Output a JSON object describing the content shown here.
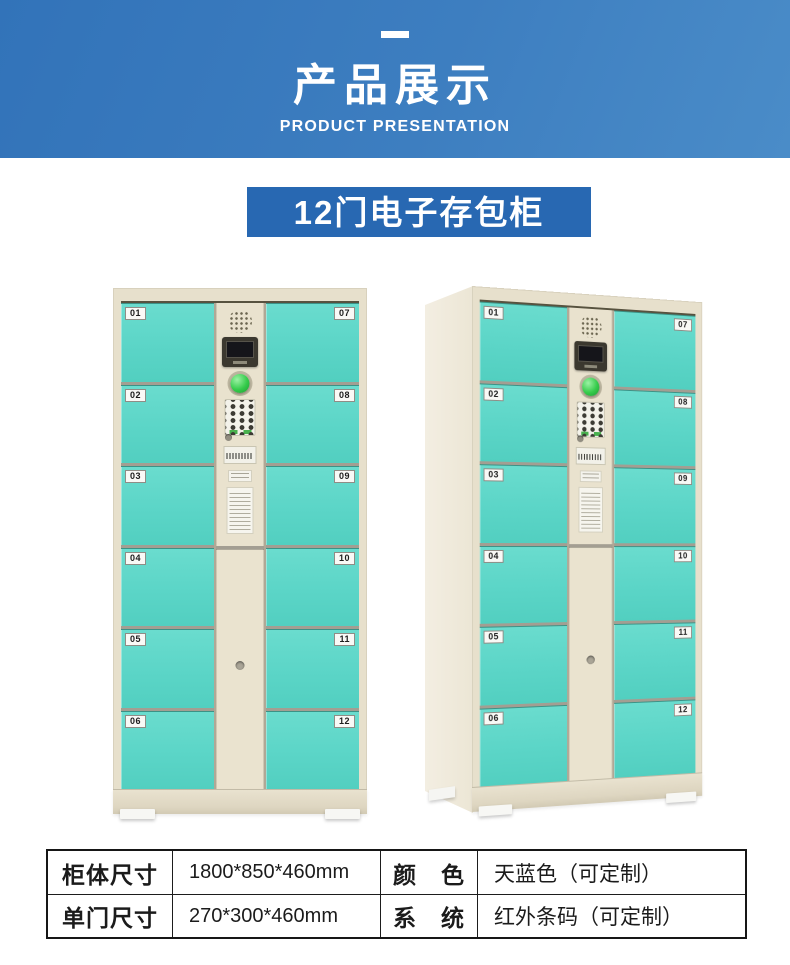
{
  "hero": {
    "title": "产品展示",
    "subtitle": "PRODUCT PRESENTATION"
  },
  "product_banner": {
    "title": "12门电子存包柜"
  },
  "cabinet": {
    "left_doors": [
      "01",
      "02",
      "03",
      "04",
      "05",
      "06"
    ],
    "right_doors": [
      "07",
      "08",
      "09",
      "10",
      "11",
      "12"
    ]
  },
  "spec_table": {
    "rows": [
      {
        "label_a": "柜体尺寸",
        "value_a": "1800*850*460mm",
        "label_b": "颜　色",
        "value_b": "天蓝色（可定制）"
      },
      {
        "label_a": "单门尺寸",
        "value_a": "270*300*460mm",
        "label_b": "系　统",
        "value_b": "红外条码（可定制）"
      }
    ]
  },
  "colors": {
    "hero_gradient_start": "#3273b9",
    "hero_gradient_end": "#4a8cc8",
    "product_banner_blue": "#2868b2",
    "door_teal": "#5bd5c7",
    "cabinet_beige": "#e7e0cc",
    "button_green": "#35cb4b",
    "table_border_black": "#161616"
  }
}
